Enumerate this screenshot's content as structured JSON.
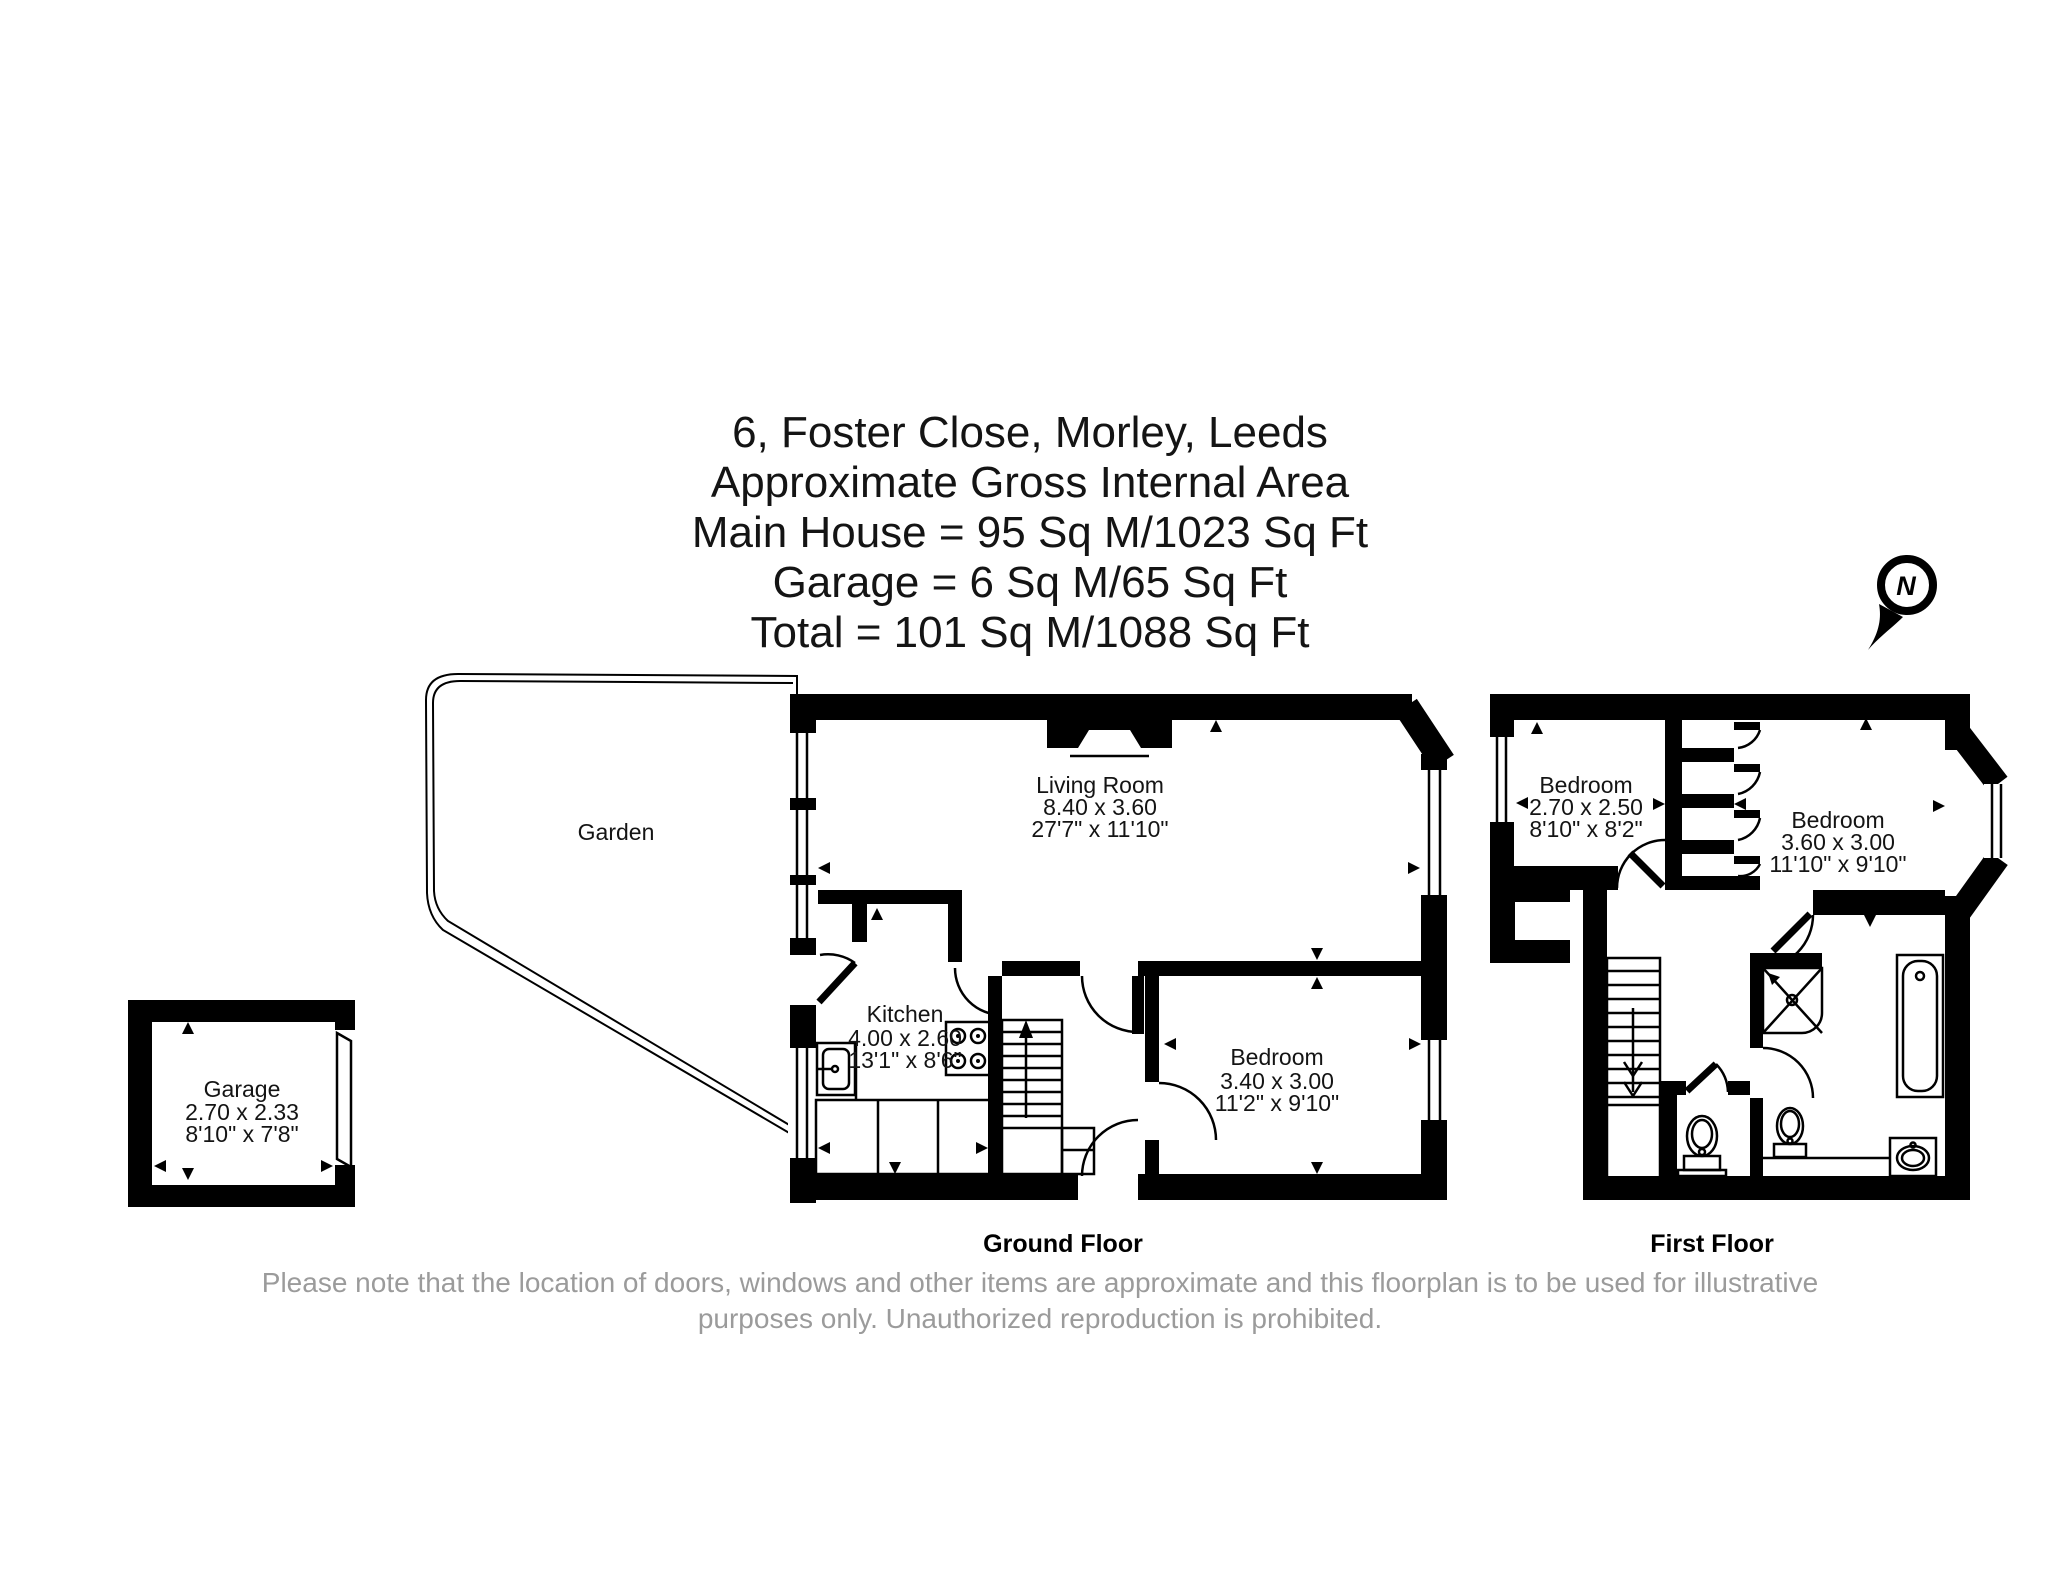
{
  "title": {
    "lines": [
      "6, Foster Close, Morley, Leeds",
      "Approximate Gross Internal Area",
      "Main House = 95 Sq M/1023 Sq Ft",
      "Garage = 6 Sq M/65 Sq Ft",
      "Total = 101 Sq M/1088 Sq Ft"
    ]
  },
  "compass": {
    "north_label": "N"
  },
  "floors": {
    "ground_label": "Ground Floor",
    "first_label": "First Floor"
  },
  "rooms": {
    "garden": {
      "name": "Garden"
    },
    "living_room": {
      "name": "Living Room",
      "metric": "8.40 x 3.60",
      "imperial": "27'7\" x 11'10\""
    },
    "kitchen": {
      "name": "Kitchen",
      "metric": "4.00 x 2.60",
      "imperial": "13'1\" x 8'6\""
    },
    "bedroom_ground": {
      "name": "Bedroom",
      "metric": "3.40 x 3.00",
      "imperial": "11'2\" x 9'10\""
    },
    "garage": {
      "name": "Garage",
      "metric": "2.70 x 2.33",
      "imperial": "8'10\" x 7'8\""
    },
    "bedroom_first_small": {
      "name": "Bedroom",
      "metric": "2.70 x 2.50",
      "imperial": "8'10\" x 8'2\""
    },
    "bedroom_first_large": {
      "name": "Bedroom",
      "metric": "3.60 x 3.00",
      "imperial": "11'10\" x 9'10\""
    }
  },
  "disclaimer": {
    "lines": [
      "Please note that the location of doors, windows and other items are approximate and this floorplan is to be used for illustrative",
      "purposes only. Unauthorized reproduction is prohibited."
    ]
  }
}
